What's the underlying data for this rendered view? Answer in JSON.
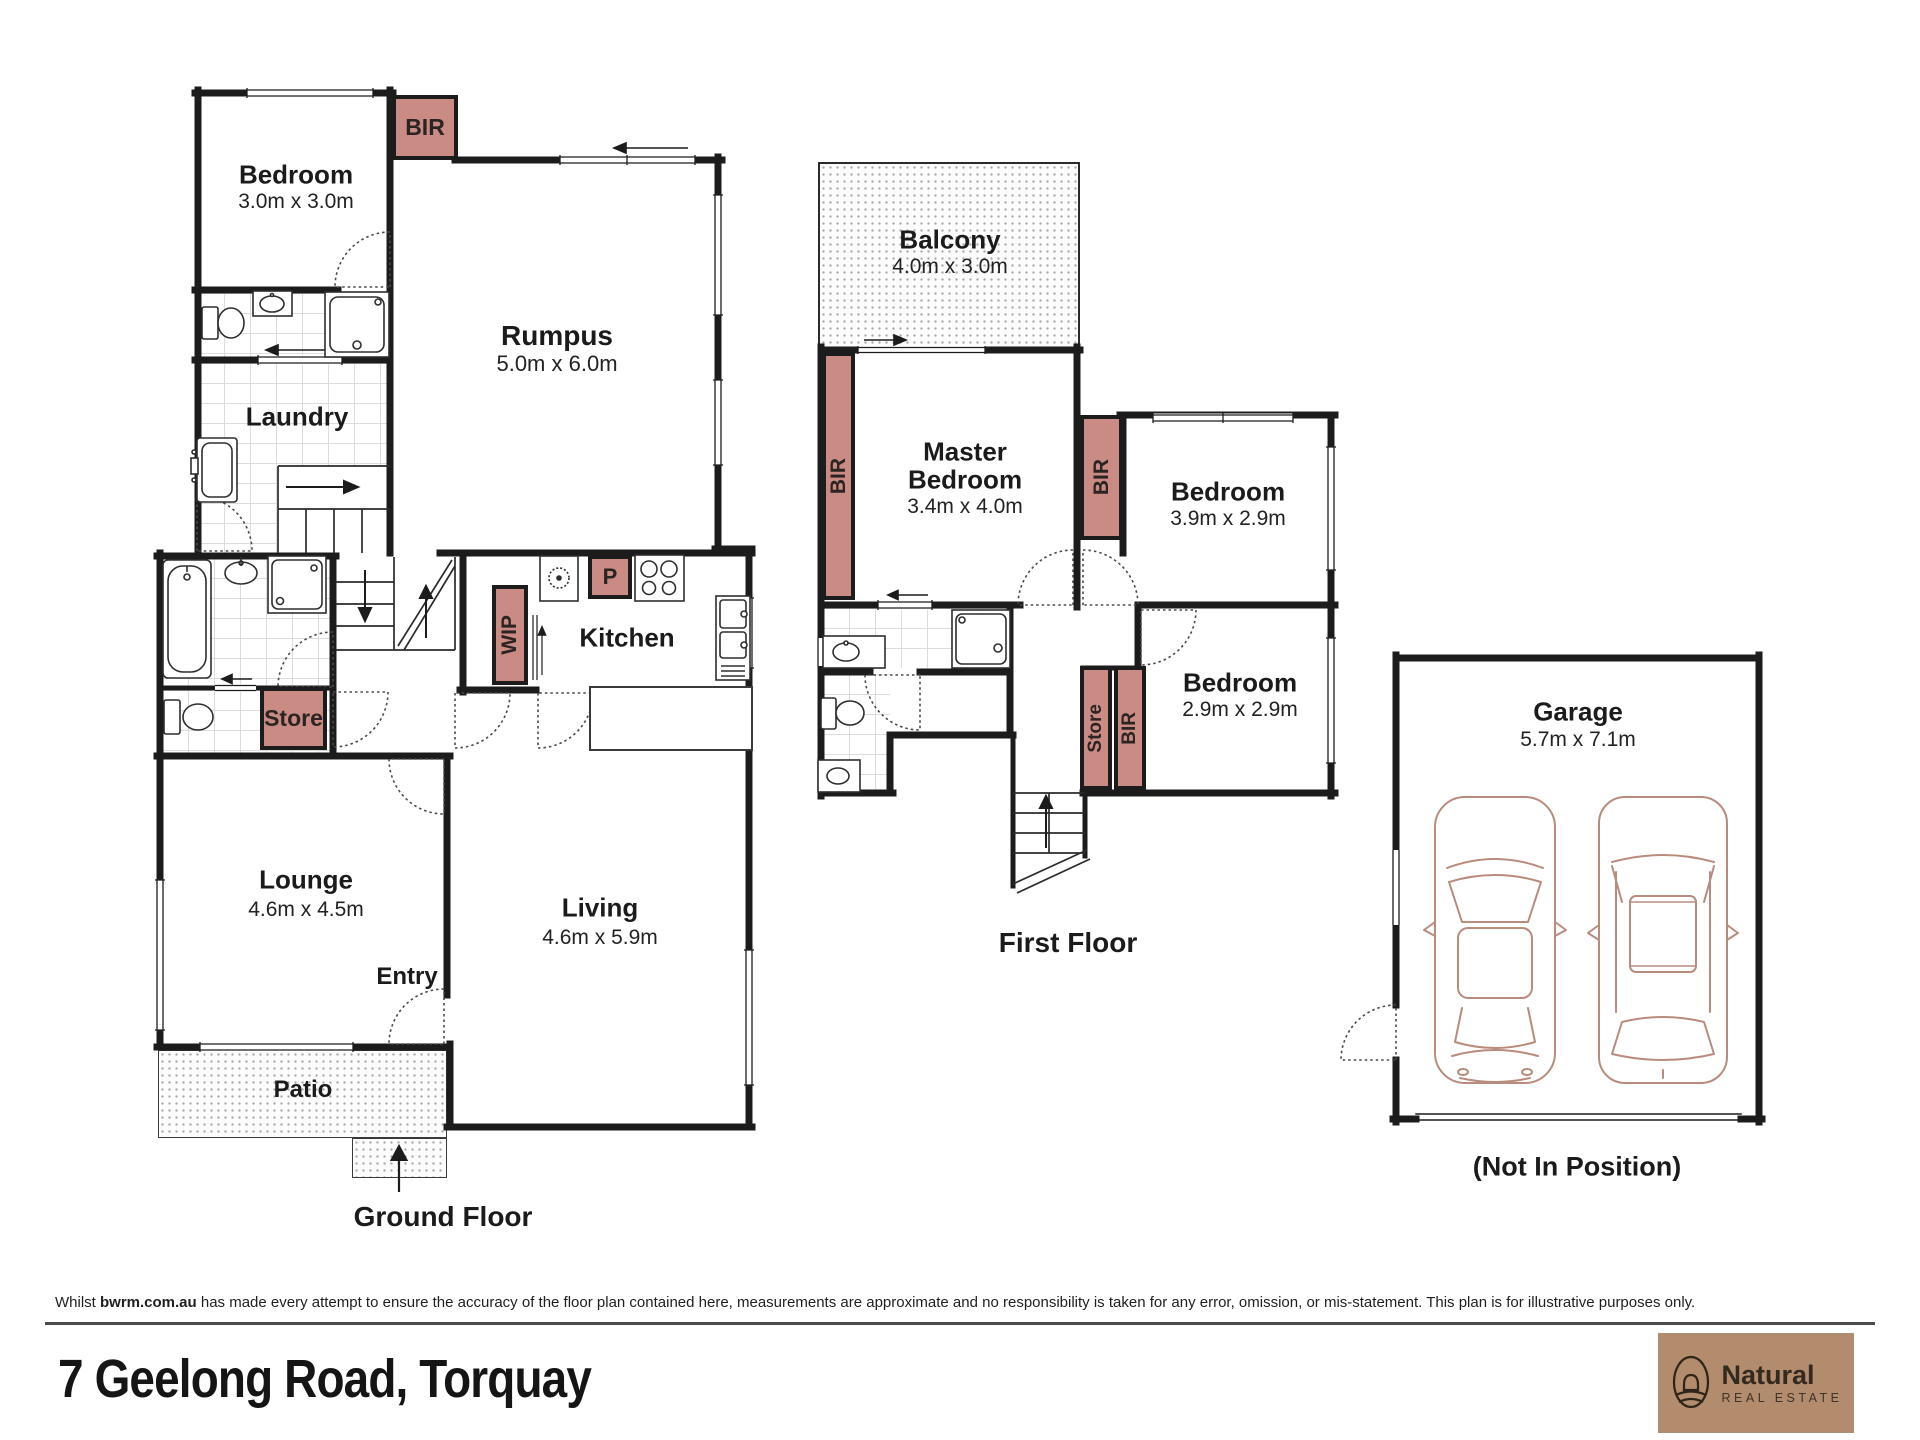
{
  "page": {
    "title_address": "7 Geelong Road, Torquay"
  },
  "disclaimer": {
    "prefix": "Whilst ",
    "source": "bwrm.com.au",
    "text": " has made every attempt to ensure the accuracy of the floor plan contained here, measurements are approximate and no responsibility is taken for any error, omission, or mis-statement. This plan is for illustrative purposes only."
  },
  "floor_labels": {
    "ground": "Ground Floor",
    "first": "First Floor",
    "garage_note": "(Not In Position)"
  },
  "rooms": {
    "bedroom1": {
      "name": "Bedroom",
      "dims": "3.0m x 3.0m"
    },
    "rumpus": {
      "name": "Rumpus",
      "dims": "5.0m x 6.0m"
    },
    "laundry": {
      "name": "Laundry"
    },
    "kitchen": {
      "name": "Kitchen"
    },
    "lounge": {
      "name": "Lounge",
      "dims": "4.6m x 4.5m"
    },
    "living": {
      "name": "Living",
      "dims": "4.6m x 5.9m"
    },
    "entry": {
      "name": "Entry"
    },
    "patio": {
      "name": "Patio"
    },
    "balcony": {
      "name": "Balcony",
      "dims": "4.0m x 3.0m"
    },
    "master": {
      "line1": "Master",
      "line2": "Bedroom",
      "dims": "3.4m x 4.0m"
    },
    "bedroom2": {
      "name": "Bedroom",
      "dims": "3.9m x 2.9m"
    },
    "bedroom3": {
      "name": "Bedroom",
      "dims": "2.9m x 2.9m"
    },
    "garage": {
      "name": "Garage",
      "dims": "5.7m x 7.1m"
    }
  },
  "storage": {
    "bir": "BIR",
    "store": "Store",
    "wip": "WIP",
    "pantry": "P"
  },
  "branding": {
    "name": "Natural",
    "tagline": "REAL ESTATE"
  },
  "colors": {
    "wall": "#1c1c1c",
    "storage_fill": "#c98b83",
    "car_outline": "#b98b7d",
    "logo_background": "#b28c6c"
  }
}
